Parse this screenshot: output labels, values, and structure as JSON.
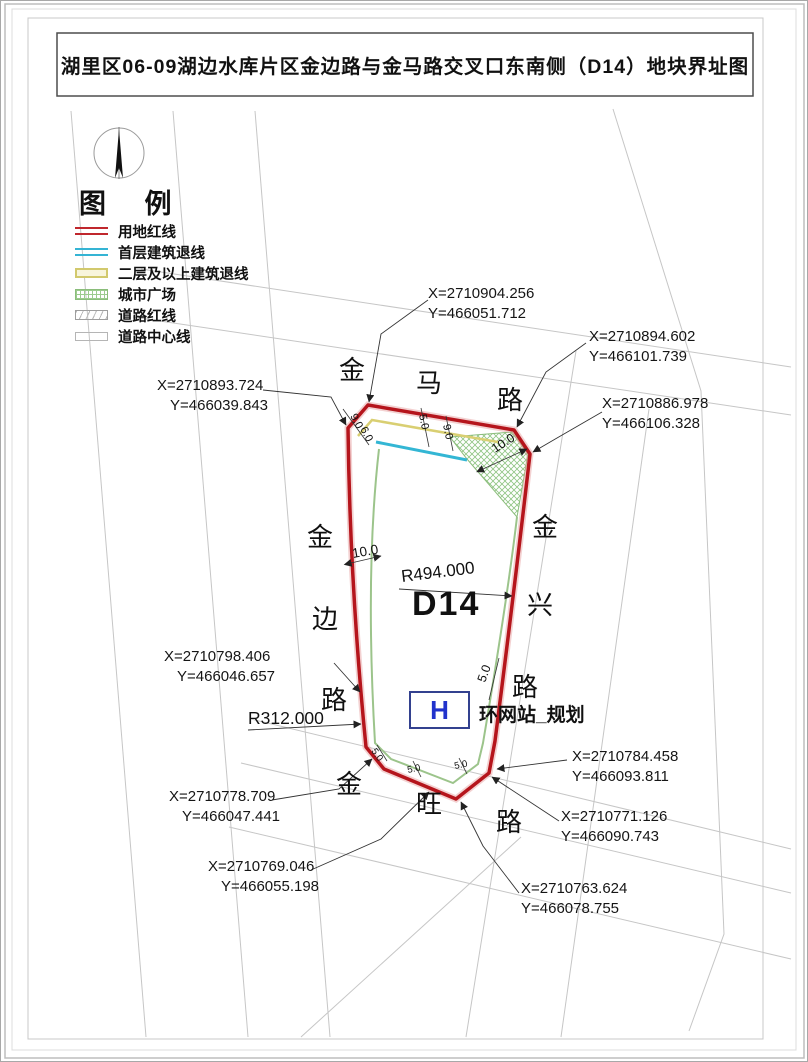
{
  "title": "湖里区06-09湖边水库片区金边路与金马路交叉口东南侧（D14）地块界址图",
  "legend": {
    "heading": "图 例",
    "items": [
      {
        "label": "用地红线"
      },
      {
        "label": "首层建筑退线"
      },
      {
        "label": "二层及以上建筑退线"
      },
      {
        "label": "城市广场"
      },
      {
        "label": "道路红线"
      },
      {
        "label": "道路中心线"
      }
    ]
  },
  "roads": {
    "top": "金马路",
    "left": "金边路",
    "right": "金兴路",
    "bottom": "金旺路"
  },
  "parcel": {
    "id": "D14",
    "station_symbol": "H",
    "station_label": "环网站_规划"
  },
  "radius": {
    "right": "R494.000",
    "left": "R312.000"
  },
  "dims": {
    "left_setback": "10.0",
    "right_setback": "5.0",
    "corner_plaza": "10.0",
    "top_yellow": "5.0",
    "top_cyan": "9.0",
    "chamfer_a": "9.0",
    "chamfer_b": "6.0",
    "bottom_a": "5.0",
    "bottom_b": "5.0",
    "bottom_c": "5.0"
  },
  "coords": {
    "c1": {
      "x": "X=2710904.256",
      "y": "Y=466051.712"
    },
    "c2": {
      "x": "X=2710894.602",
      "y": "Y=466101.739"
    },
    "c3": {
      "x": "X=2710886.978",
      "y": "Y=466106.328"
    },
    "c4": {
      "x": "X=2710893.724",
      "y": "Y=466039.843"
    },
    "c5": {
      "x": "X=2710798.406",
      "y": "Y=466046.657"
    },
    "c6": {
      "x": "X=2710778.709",
      "y": "Y=466047.441"
    },
    "c7": {
      "x": "X=2710769.046",
      "y": "Y=466055.198"
    },
    "c8": {
      "x": "X=2710784.458",
      "y": "Y=466093.811"
    },
    "c9": {
      "x": "X=2710771.126",
      "y": "Y=466090.743"
    },
    "c10": {
      "x": "X=2710763.624",
      "y": "Y=466078.755"
    }
  }
}
